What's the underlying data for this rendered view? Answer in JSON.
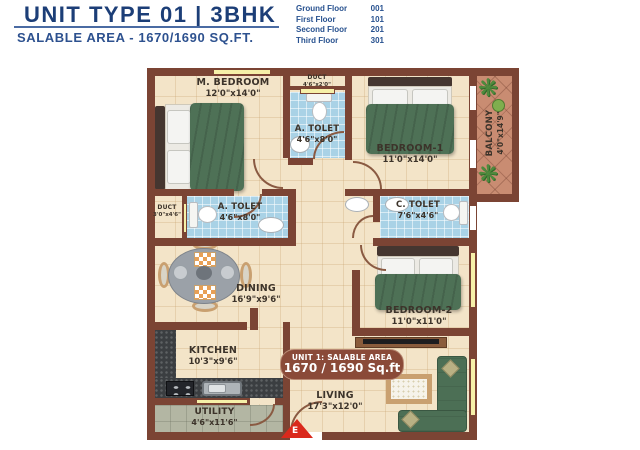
{
  "header": {
    "title": "UNIT TYPE 01 | 3BHK",
    "subtitle": "SALABLE AREA - 1670/1690 SQ.FT."
  },
  "floor_directory": [
    {
      "label": "Ground Floor",
      "number": "001"
    },
    {
      "label": "First Floor",
      "number": "101"
    },
    {
      "label": "Second Floor",
      "number": "201"
    },
    {
      "label": "Third Floor",
      "number": "301"
    }
  ],
  "unit_badge": {
    "line1": "UNIT 1: SALABLE AREA",
    "line2": "1670 / 1690 Sq.ft"
  },
  "entrance": {
    "label": "E"
  },
  "icons": {
    "plant": "❋"
  },
  "rooms": {
    "m_bedroom": {
      "name": "M. BEDROOM",
      "dims": "12'0\"x14'0\""
    },
    "duct_top": {
      "name": "DUCT",
      "dims": "4'6\"x2'0\""
    },
    "a_toilet_top": {
      "name": "A. TOLET",
      "dims": "4'6\"x8'0\""
    },
    "bedroom_1": {
      "name": "BEDROOM-1",
      "dims": "11'0\"x14'0\""
    },
    "balcony": {
      "name": "BALCONY",
      "dims": "4'0\"x14'9\""
    },
    "duct_mid": {
      "name": "DUCT",
      "dims": "3'0\"x4'6\""
    },
    "a_toilet_mid": {
      "name": "A. TOLET",
      "dims": "4'6\"x8'0\""
    },
    "c_toilet": {
      "name": "C. TOLET",
      "dims": "7'6\"x4'6\""
    },
    "dining": {
      "name": "DINING",
      "dims": "16'9\"x9'6\""
    },
    "bedroom_2": {
      "name": "BEDROOM-2",
      "dims": "11'0\"x11'0\""
    },
    "kitchen": {
      "name": "KITCHEN",
      "dims": "10'3\"x9'6\""
    },
    "utility": {
      "name": "UTILITY",
      "dims": "4'6\"x11'6\""
    },
    "living": {
      "name": "LIVING",
      "dims": "17'3\"x12'0\""
    }
  },
  "colors": {
    "accent_blue": "#1c3e77",
    "wall": "#7b4434",
    "floor": "#f3e4c8",
    "toilet_tile": "#a9d2e6",
    "balcony_tile": "#c98c72",
    "utility_floor": "#b3b6a3",
    "furniture_green": "#4e7156",
    "window_yellow": "#f6f0a8",
    "badge_red": "#8a4a38",
    "entrance_red": "#da291c"
  }
}
